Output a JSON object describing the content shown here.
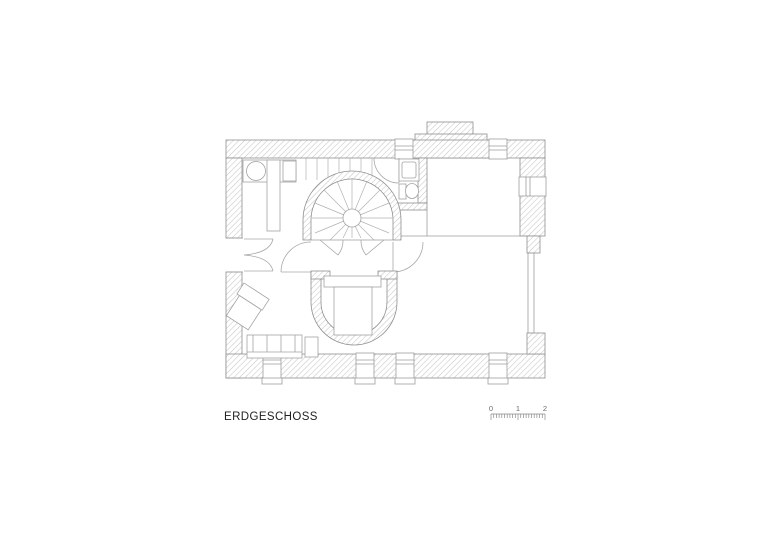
{
  "title": {
    "label": "ERDGESCHOSS"
  },
  "scale_bar": {
    "labels": [
      "0",
      "1",
      "2"
    ],
    "minor_ticks_per_unit": 10
  },
  "colors": {
    "background": "#ffffff",
    "wall_outline": "#8f8f8f",
    "wall_hatch": "#c6c6c6",
    "thin_line": "#9d9d9d",
    "title_text": "#1f1f1f",
    "scale_text": "#6b6b6b"
  }
}
